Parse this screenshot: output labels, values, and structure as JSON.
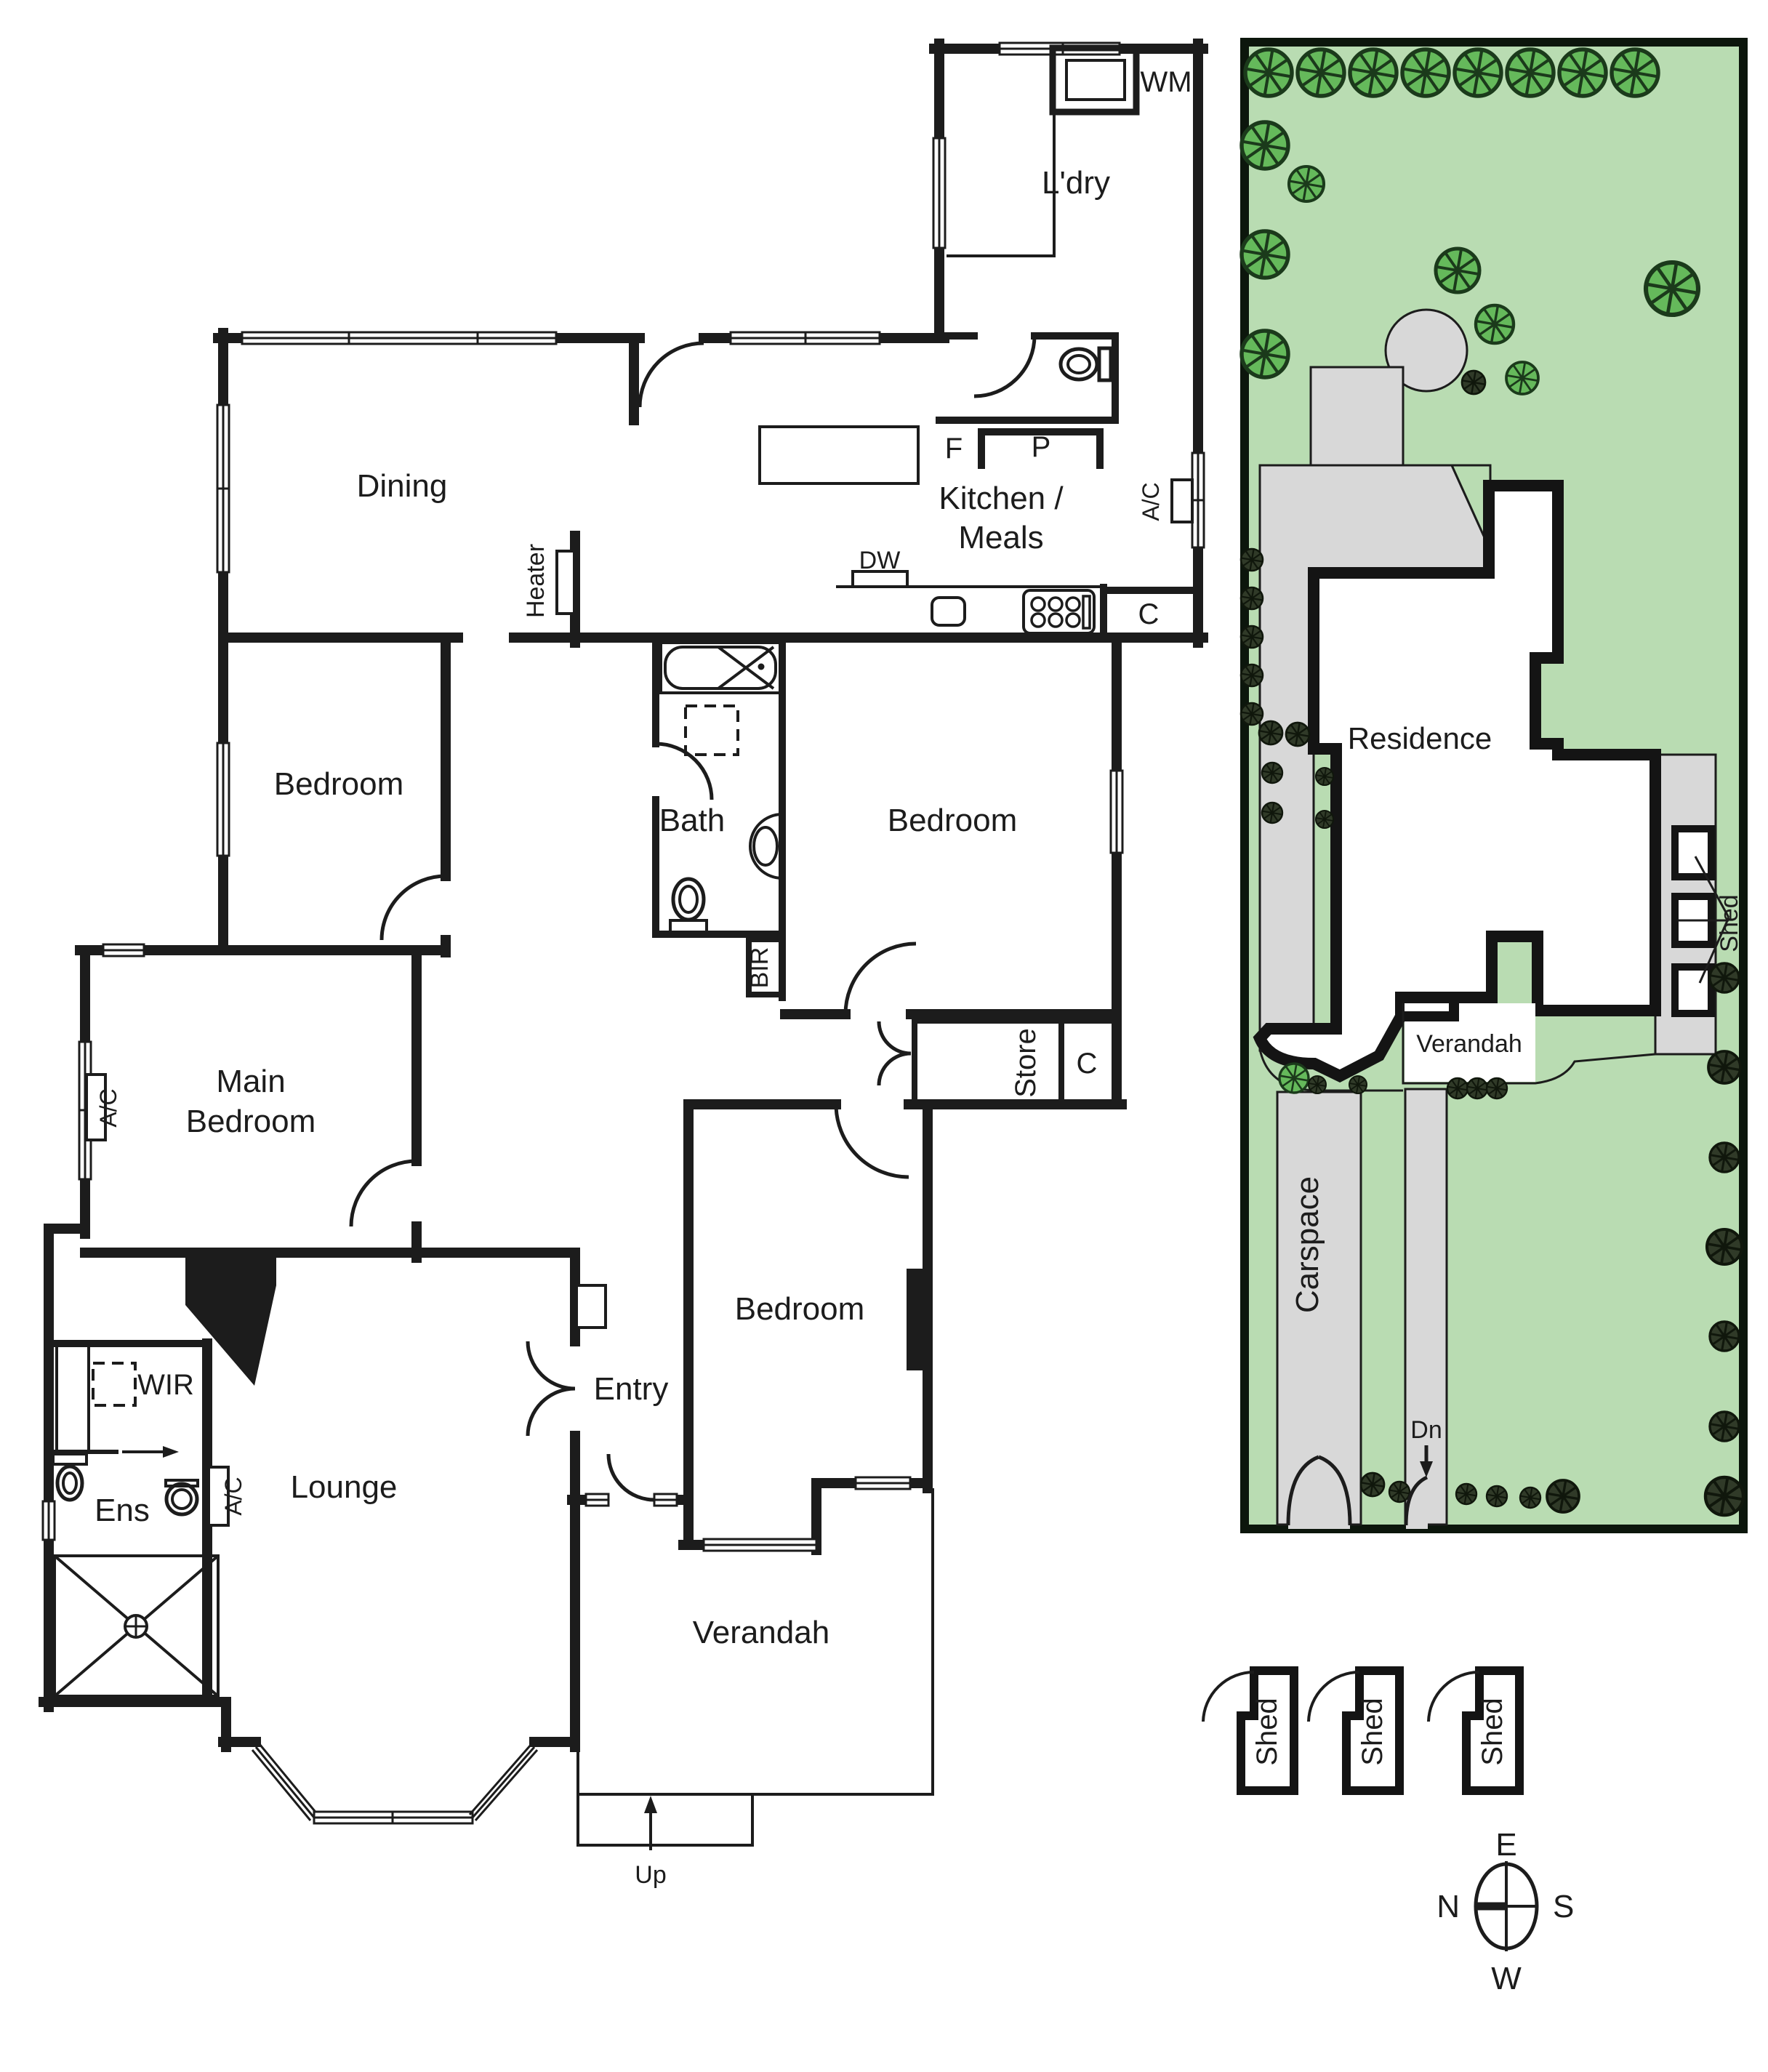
{
  "floor": {
    "dining": "Dining",
    "bedroom_left": "Bedroom",
    "bedroom_middle": "Bedroom",
    "bedroom_front": "Bedroom",
    "main_bedroom": [
      "Main",
      "Bedroom"
    ],
    "kitchen_meals": [
      "Kitchen /",
      "Meals"
    ],
    "laundry": "L'dry",
    "bath": "Bath",
    "ensuite": "Ens",
    "wir": "WIR",
    "lounge": "Lounge",
    "entry": "Entry",
    "store": "Store",
    "verandah": "Verandah",
    "heater": "Heater",
    "bir": "BIR",
    "washing_machine": "WM",
    "fridge": "F",
    "pantry": "P",
    "dishwasher": "DW",
    "cupboard_kitchen": "C",
    "cupboard_store": "C",
    "ac_kitchen": "A/C",
    "ac_main_bedroom": "A/C",
    "ac_ensuite": "A/C",
    "up": "Up"
  },
  "site": {
    "residence": "Residence",
    "verandah": "Verandah",
    "carspace": "Carspace",
    "dn": "Dn",
    "shed_pointer": "Shed",
    "sheds": [
      "Shed",
      "Shed",
      "Shed"
    ]
  },
  "compass": {
    "north": "N",
    "east": "E",
    "south": "S",
    "west": "W"
  },
  "colors": {
    "wall": "#1c1c1c",
    "garden_green": "#b9dcb2",
    "tree_green": "#65b95b",
    "bush_dark": "#303a28",
    "paving_gray": "#d8d8d8"
  }
}
